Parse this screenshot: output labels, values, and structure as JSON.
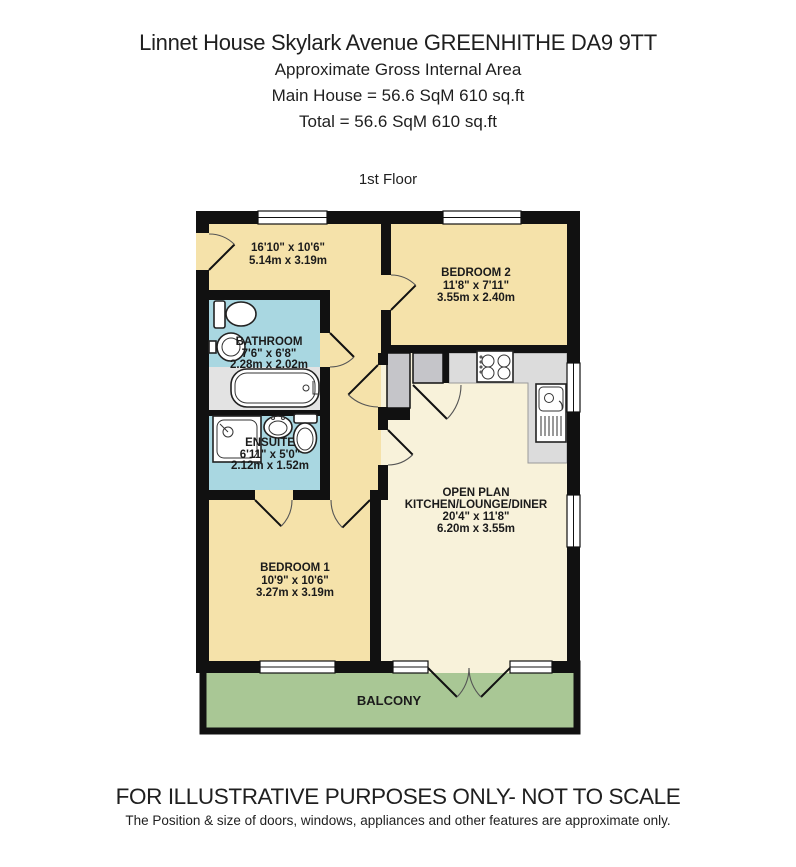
{
  "header": {
    "title": "Linnet House Skylark Avenue GREENHITHE DA9 9TT",
    "subtitle": "Approximate Gross Internal Area",
    "main_house_area": "Main House = 56.6 SqM  610 sq.ft",
    "total_area": "Total = 56.6 SqM  610  sq.ft",
    "floor_label": "1st Floor"
  },
  "rooms": {
    "landing": {
      "dims_imperial": "16'10\"  x 10'6\"",
      "dims_metric": "5.14m  x 3.19m"
    },
    "bedroom2": {
      "name": "BEDROOM 2",
      "dims_imperial": "11'8\"  x 7'11\"",
      "dims_metric": "3.55m  x 2.40m"
    },
    "bathroom": {
      "name": "BATHROOM",
      "dims_imperial": "7'6\"  x 6'8\"",
      "dims_metric": "2.28m  x 2.02m"
    },
    "ensuite": {
      "name": "ENSUITE",
      "dims_imperial": "6'11\"  x 5'0\"",
      "dims_metric": "2.12m  x 1.52m"
    },
    "bedroom1": {
      "name": "BEDROOM 1",
      "dims_imperial": "10'9\"  x 10'6\"",
      "dims_metric": "3.27m  x 3.19m"
    },
    "open_plan": {
      "name_line1": "OPEN PLAN",
      "name_line2": "KITCHEN/LOUNGE/DINER",
      "dims_imperial": "20'4\"  x 11'8\"",
      "dims_metric": "6.20m  x 3.55m"
    },
    "balcony": {
      "name": "BALCONY"
    }
  },
  "footer": {
    "disclaimer": "FOR ILLUSTRATIVE PURPOSES ONLY- NOT TO SCALE",
    "note": "The Position & size of doors, windows, appliances and other features are approximate only."
  },
  "colors": {
    "wall": "#111111",
    "floor": "#f5e2aa",
    "open_plan": "#f8f2da",
    "wet_room": "#a9d7e1",
    "balcony": "#a9c795",
    "counter": "#dcdcdc",
    "cupboard": "#c5c5c9",
    "alcove": "#e3e3e3"
  }
}
